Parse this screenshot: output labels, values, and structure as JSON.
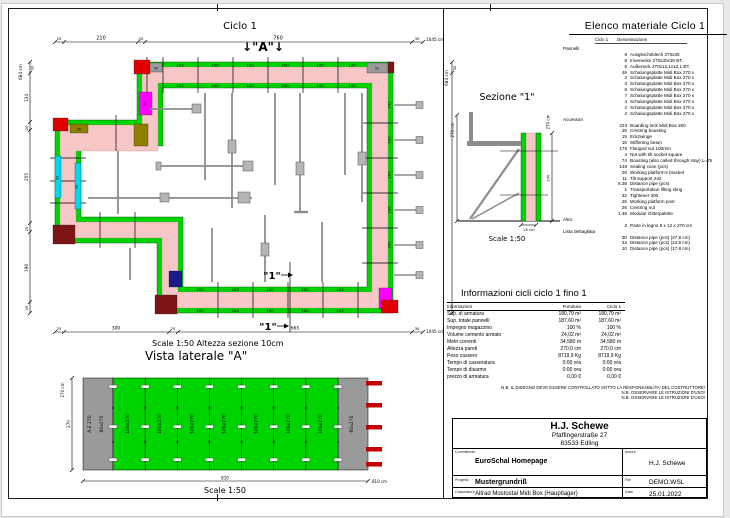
{
  "plan": {
    "title": "Ciclo 1",
    "marker_a": "↓\"A\"↓",
    "section_marker": "\"1\"",
    "scale_note": "Scale 1:50   Altezza sezione 10cm",
    "dim_top": {
      "a": "25",
      "b": "210",
      "c": "20",
      "d": "760",
      "e": "30",
      "total": "1045 cm"
    },
    "dim_bottom": {
      "a": "25",
      "b": "300",
      "c": "25",
      "d": "665",
      "e": "30",
      "total": "1045 cm"
    },
    "dim_left": {
      "a": "30",
      "b": "134",
      "c": "20",
      "d": "255",
      "e": "25",
      "f": "190",
      "g": "25",
      "total": "684 cm"
    },
    "dim_right": {
      "a": "30",
      "total": "684 cm"
    },
    "panel_100": "100",
    "panel_50": "50",
    "panel_55": "55"
  },
  "sezione": {
    "title": "Sezione \"1\"",
    "dim_left_total": "270 cm",
    "dim_right_total": "270 cm",
    "dim_right_inner": "270",
    "dim_bottom": "25 cm",
    "scale": "Scale 1:50"
  },
  "vista": {
    "title": "Vista laterale \"A\"",
    "dim_left_total": "270 cm",
    "dim_left_inner": "270",
    "label_ae": "A.E 270",
    "label_60": "60x270",
    "label_100": "100x270",
    "dim_bottom": "810",
    "dim_bottom_total": "810 cm",
    "scale": "Scale 1:50"
  },
  "materials": {
    "title": "Elenco materiale  Ciclo 1",
    "col_ciclo": "Ciclo 1",
    "col_denominazione": "Denominazione",
    "rows": [
      {
        "g": "Pannelli"
      },
      {
        "q": "8",
        "n": "Ausgleichsblech 270x35"
      },
      {
        "q": "8",
        "n": "Innenecke 270x30x30 BT."
      },
      {
        "q": "6",
        "n": "Außeneck 270x12,1x12,1 BT."
      },
      {
        "q": "46",
        "n": "Schalungsplatte Midi Box 270 x"
      },
      {
        "q": "2",
        "n": "Schalungsplatte Midi Box 270 x"
      },
      {
        "q": "3",
        "n": "Schalungsplatte Midi Box 270 x"
      },
      {
        "q": "6",
        "n": "Schalungsplatte Midi Box 270 x"
      },
      {
        "q": "7",
        "n": "Schalungsplatte Midi Box 270 x"
      },
      {
        "q": "4",
        "n": "Schalungsplatte Midi Box 270 x"
      },
      {
        "q": "2",
        "n": "Schalungsplatte Midi Box 270 x"
      },
      {
        "q": "2",
        "n": "Schalungsplatte Midi Box 270 x"
      },
      {
        "g": "Accessori"
      },
      {
        "q": "223",
        "n": "Boarding lock Midi Box 260"
      },
      {
        "q": "26",
        "n": "Centring bousting"
      },
      {
        "q": "15",
        "n": "Eckzwinge"
      },
      {
        "q": "16",
        "n": "Stiffening beam"
      },
      {
        "q": "176",
        "n": "Flanged nut 100mm"
      },
      {
        "q": "4",
        "n": "Nut with tilt socket square"
      },
      {
        "q": "74",
        "n": "Bousting (also called through stay) L=75"
      },
      {
        "q": "148",
        "n": "Sealing cone (pcs)"
      },
      {
        "q": "26",
        "n": "Working platform's bracket"
      },
      {
        "q": "11",
        "n": "Tilt support 242"
      },
      {
        "q": "6.38",
        "n": "Distance pipe (pcs)"
      },
      {
        "q": "1",
        "n": "Transportation lifting sling"
      },
      {
        "q": "32",
        "n": "Tightener 300"
      },
      {
        "q": "25",
        "n": "Working platform post"
      },
      {
        "q": "26",
        "n": "Centring nut"
      },
      {
        "q": "1.49",
        "n": "Modular Gitterpalette"
      },
      {
        "g": "Altro"
      },
      {
        "q": "2",
        "n": "Parte in legno 9 x 12 x 270 cm"
      },
      {
        "g": "Lista dettagliata"
      },
      {
        "q": "30",
        "n": "Distance pipe (pcs) (27.8 cm)"
      },
      {
        "q": "34",
        "n": "Distance pipe (pcs) (22.8 cm)"
      },
      {
        "q": "10",
        "n": "Distance pipe (pcs) (17.8 cm)"
      }
    ]
  },
  "info": {
    "title": "Informazioni cicli  ciclo 1 fino 1",
    "col_label": "Informazioni",
    "col_fornitura": "Fornitura",
    "col_ciclo": "Ciclo 1",
    "rows": [
      {
        "l": "Sup. di armatura",
        "f": "180,79 m²",
        "c": "180,79 m²"
      },
      {
        "l": "Sup. totale pannelli",
        "f": "187,60 m²",
        "c": "187,60 m²"
      },
      {
        "l": "Impegno magazzino",
        "f": "100 %",
        "c": "100 %"
      },
      {
        "l": "Volume cemento armato",
        "f": "24,02 m³",
        "c": "24,02 m³"
      },
      {
        "l": "Metri correnti",
        "f": "34,580 m",
        "c": "34,580 m"
      },
      {
        "l": "Altezza pareti",
        "f": "270,0 cm",
        "c": "270,0 cm"
      },
      {
        "l": "Peso cassero",
        "f": "8719,9 Kg",
        "c": "8719,9 Kg"
      },
      {
        "l": "Tempo di casseratura",
        "f": "0:00 ora",
        "c": "0:00 ora"
      },
      {
        "l": "Tempo di disarmo",
        "f": "0:00 ora",
        "c": "0:00 ora"
      },
      {
        "l": "prezzo di armatura",
        "f": "0,00 €",
        "c": "0,00 €"
      }
    ],
    "nb_lines": [
      "N.B. IL DISEGNO DEVE ESSERE CONTROLLATO SOTTO LA RESPONSABILITA' DEL COSTRUTTORE!",
      "N.B. OSSERVARE LE ISTRUZIONI D'USO!",
      "N.B. OSSERVARE LE ISTRUZIONI D'USO!"
    ]
  },
  "titleblock": {
    "company": "H.J. Schewe",
    "address1": "Pfaffingerstraße 27",
    "address2": "83533 Edling",
    "committente_label": "Committente",
    "committente": "EuroSchal Homepage",
    "autore_label": "Autore",
    "autore": "H.J. Schewe",
    "progetto_label": "Progetto",
    "progetto": "Mustergrundriß",
    "file_label": "File",
    "file": "DEMO.WSL",
    "casseratura_label": "Casseratura",
    "casseratura": "Altrad Mostostal Midi Box (Hauptlager)",
    "data_label": "Data",
    "data": "25.01.2022"
  },
  "colors": {
    "panel_green": "#00d400",
    "concrete_pink": "#f7c7c7",
    "corner_red": "#e00000",
    "corner_darkred": "#7c1414",
    "corner_magenta": "#ff00ff",
    "corner_cyan": "#00d9f2",
    "corner_olive": "#8f7f00",
    "support_gray": "#8c8c8c"
  }
}
